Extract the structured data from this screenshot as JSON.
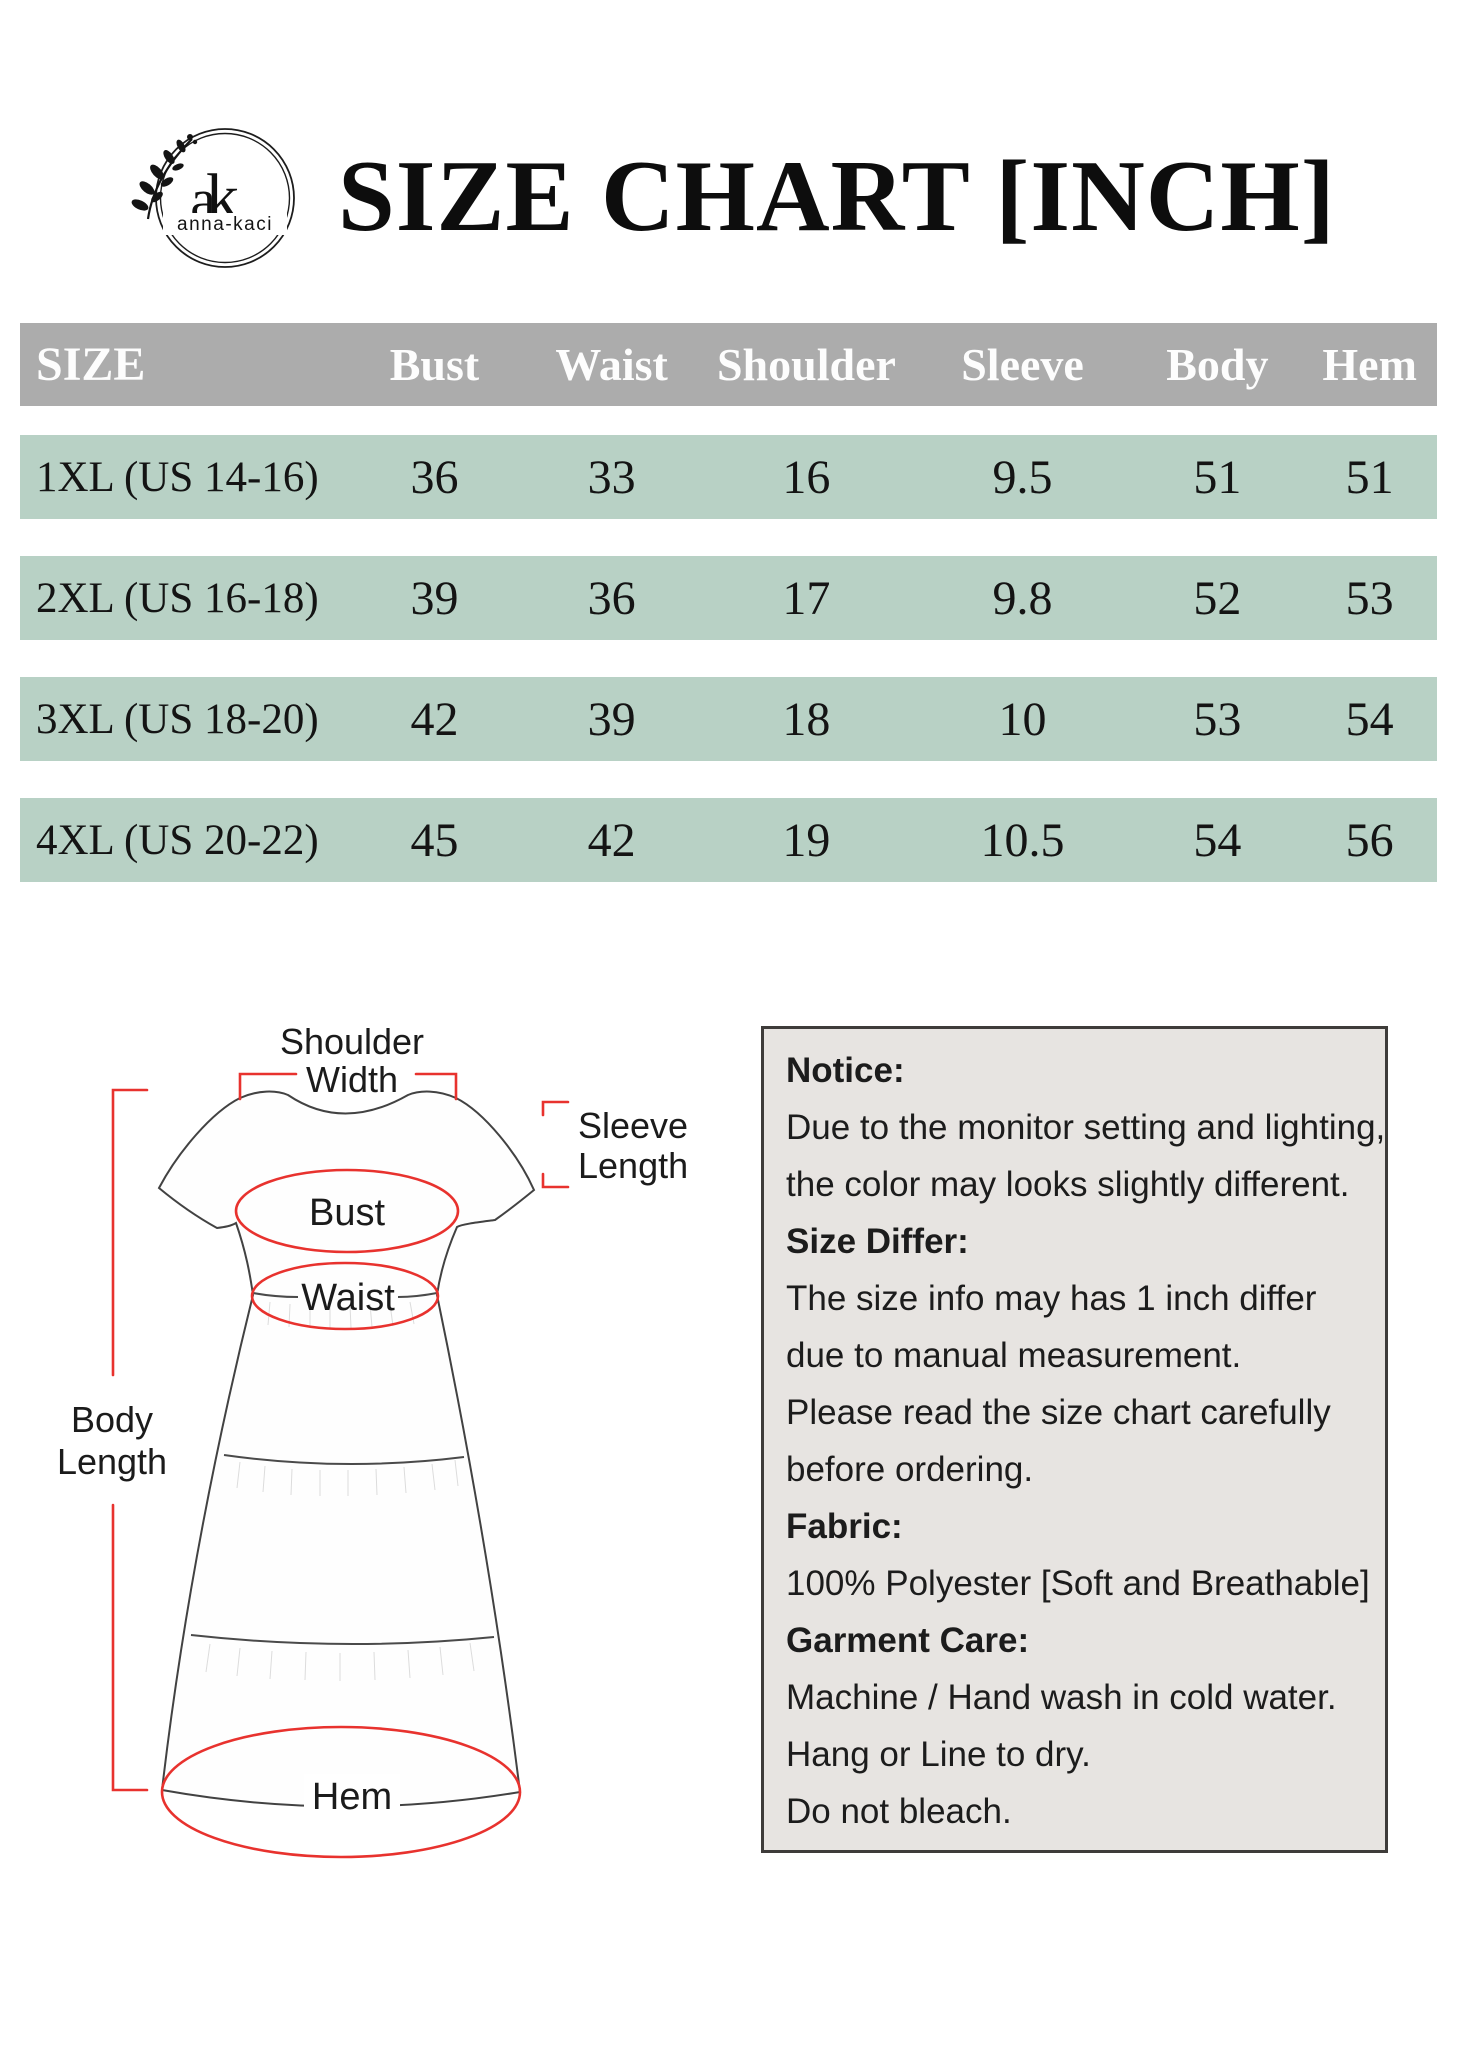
{
  "brand": {
    "monogram_a": "a",
    "monogram_k": "k",
    "name": "anna-kaci"
  },
  "title": "SIZE CHART [INCH]",
  "table": {
    "columns": [
      "SIZE",
      "Bust",
      "Waist",
      "Shoulder",
      "Sleeve",
      "Body",
      "Hem"
    ],
    "rows": [
      {
        "size": "1XL (US 14-16)",
        "bust": "36",
        "waist": "33",
        "shoulder": "16",
        "sleeve": "9.5",
        "body": "51",
        "hem": "51"
      },
      {
        "size": "2XL (US 16-18)",
        "bust": "39",
        "waist": "36",
        "shoulder": "17",
        "sleeve": "9.8",
        "body": "52",
        "hem": "53"
      },
      {
        "size": "3XL (US 18-20)",
        "bust": "42",
        "waist": "39",
        "shoulder": "18",
        "sleeve": "10",
        "body": "53",
        "hem": "54"
      },
      {
        "size": "4XL (US 20-22)",
        "bust": "45",
        "waist": "42",
        "shoulder": "19",
        "sleeve": "10.5",
        "body": "54",
        "hem": "56"
      }
    ]
  },
  "diagram": {
    "labels": {
      "shoulder_line1": "Shoulder",
      "shoulder_line2": "Width",
      "sleeve_line1": "Sleeve",
      "sleeve_line2": "Length",
      "body_line1": "Body",
      "body_line2": "Length",
      "bust": "Bust",
      "waist": "Waist",
      "hem": "Hem"
    }
  },
  "notice": {
    "lines": [
      {
        "text": "Notice:",
        "bold": true
      },
      {
        "text": "Due to the monitor setting and lighting,",
        "bold": false
      },
      {
        "text": "the color may looks slightly different.",
        "bold": false
      },
      {
        "text": "Size Differ:",
        "bold": true
      },
      {
        "text": "The size info may has 1 inch differ",
        "bold": false
      },
      {
        "text": "due to manual measurement.",
        "bold": false
      },
      {
        "text": "Please read the size chart carefully",
        "bold": false
      },
      {
        "text": "before ordering.",
        "bold": false
      },
      {
        "text": "Fabric:",
        "bold": true
      },
      {
        "text": "100% Polyester [Soft and Breathable]",
        "bold": false
      },
      {
        "text": "Garment Care:",
        "bold": true
      },
      {
        "text": "Machine / Hand wash in cold water.",
        "bold": false
      },
      {
        "text": "Hang or Line to dry.",
        "bold": false
      },
      {
        "text": "Do not bleach.",
        "bold": false
      }
    ]
  },
  "colors": {
    "header_bg": "#acacac",
    "row_bg": "#b8d1c5",
    "notice_bg": "#e7e4e1",
    "annotation_red": "#e8322e"
  }
}
